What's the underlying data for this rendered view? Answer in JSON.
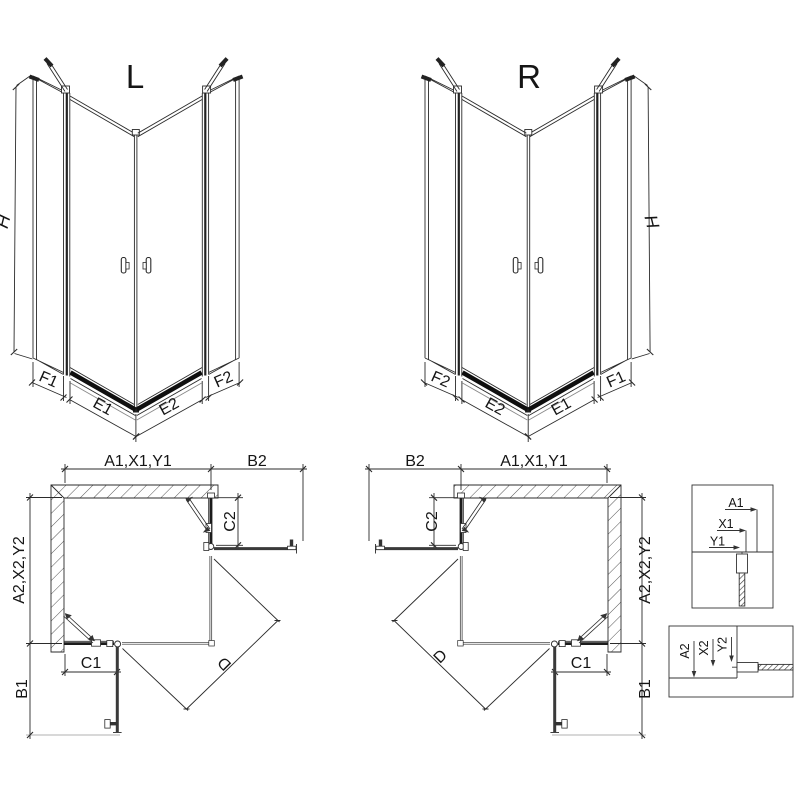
{
  "diagram": {
    "iso_left": {
      "title": "L",
      "dim_h": "H",
      "dim_f1": "F1",
      "dim_e1": "E1",
      "dim_e2": "E2",
      "dim_f2": "F2"
    },
    "iso_right": {
      "title": "R",
      "dim_h": "H",
      "dim_f1": "F1",
      "dim_e1": "E1",
      "dim_e2": "E2",
      "dim_f2": "F2"
    },
    "plan_left": {
      "dim_a1": "A1,X1,Y1",
      "dim_b2": "B2",
      "dim_c2": "C2",
      "dim_a2": "A2,X2,Y2",
      "dim_c1": "C1",
      "dim_b1": "B1",
      "dim_d": "D"
    },
    "plan_right": {
      "dim_a1": "A1,X1,Y1",
      "dim_b2": "B2",
      "dim_c2": "C2",
      "dim_a2": "A2,X2,Y2",
      "dim_c1": "C1",
      "dim_b1": "B1",
      "dim_d": "D"
    },
    "detail_horizontal": {
      "dim_a": "A1",
      "dim_x": "X1",
      "dim_y": "Y1"
    },
    "detail_vertical": {
      "dim_a": "A2",
      "dim_x": "X2",
      "dim_y": "Y2"
    }
  },
  "colors": {
    "line": "#2b2b2b",
    "thick_profile": "#1c1c1c",
    "tray": "#0f0f0f",
    "wall_hatch": "#555555"
  }
}
